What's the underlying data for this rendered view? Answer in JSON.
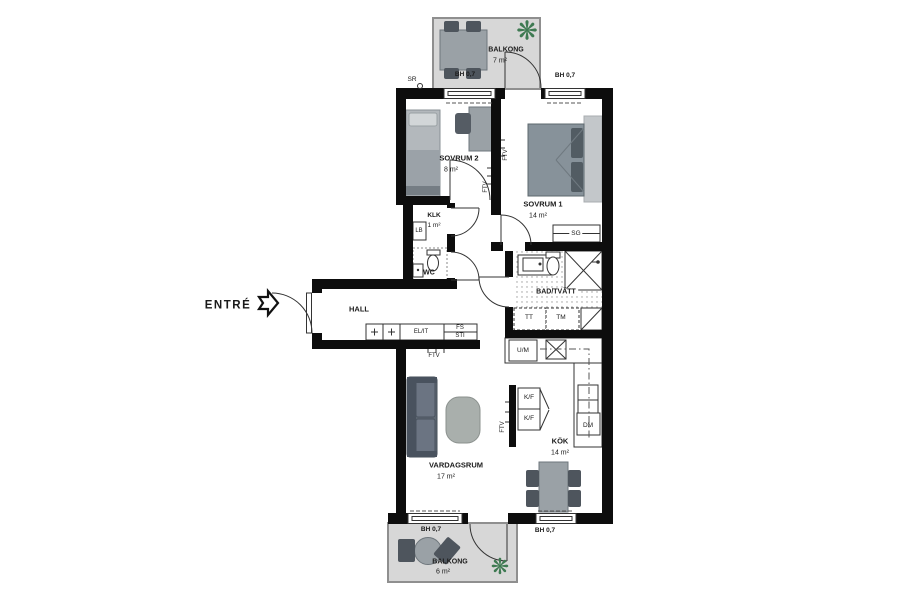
{
  "entrance": {
    "label": "ENTRÉ"
  },
  "rooms": {
    "hall": {
      "name": "HALL"
    },
    "sovrum2": {
      "name": "SOVRUM 2",
      "area": "8 m²"
    },
    "sovrum1": {
      "name": "SOVRUM 1",
      "area": "14 m²"
    },
    "klk": {
      "name": "KLK",
      "area": "1 m²"
    },
    "wc": {
      "name": "WC"
    },
    "bad": {
      "name": "BAD/TVÄTT"
    },
    "kok": {
      "name": "KÖK",
      "area": "14 m²"
    },
    "vardagsrum": {
      "name": "VARDAGSRUM",
      "area": "17 m²"
    },
    "balkong_top": {
      "name": "BALKONG",
      "area": "7 m²"
    },
    "balkong_bottom": {
      "name": "BALKONG",
      "area": "6 m²"
    }
  },
  "fixtures": {
    "lb": "LB",
    "sg": "SG",
    "tt": "TT",
    "tm": "TM",
    "um": "U/M",
    "kf_top": "K/F",
    "kf_bottom": "K/F",
    "dm": "DM",
    "el_it": "EL/IT",
    "fs": "FS",
    "sti": "STI",
    "sr": "SR",
    "ftv": "FTV"
  },
  "window_labels": {
    "bh": [
      "BH 0,7",
      "BH 0,7",
      "BH 0,7",
      "BH 0,7"
    ]
  },
  "icons": {
    "plant_glyph": "❋"
  },
  "colors": {
    "wall": "#0d0d0d",
    "balcony_fill": "#d7d7d7",
    "furniture_gray": "#9aa1a6",
    "chair_dark": "#4e555d",
    "sofa": "#5d6772",
    "plant_green": "#3e7a52",
    "text": "#1a1a1a"
  }
}
